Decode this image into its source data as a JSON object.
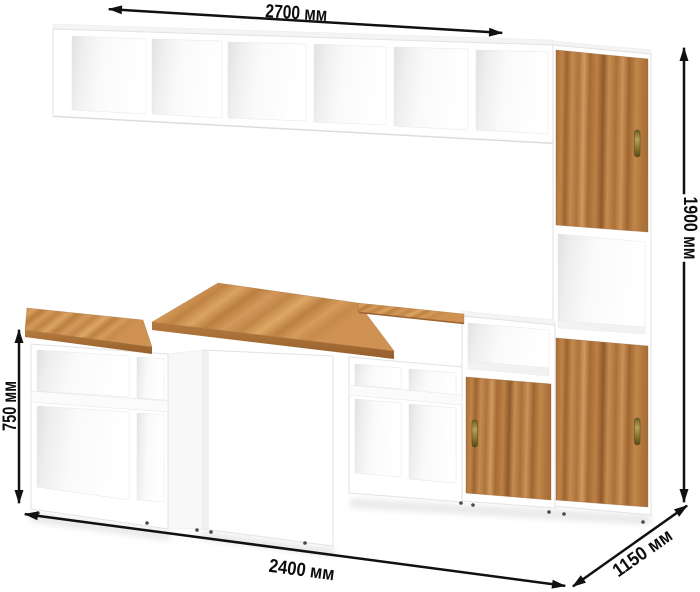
{
  "diagram": {
    "background": "#ffffff",
    "dimension_labels": {
      "top_width": "2700 мм",
      "right_height": "1900 мм",
      "left_height": "750 мм",
      "bottom_width": "2400 мм",
      "depth": "1150 мм"
    },
    "colors": {
      "dimension_line": "#111111",
      "label_text": "#0d0d0d",
      "cabinet_white": "#ffffff",
      "door_wood": "#b5793f",
      "door_wood_light": "#d09a5c",
      "door_wood_dark": "#8f5a2b",
      "desk_wood": "#c88e4d",
      "handle_brass": "#8d7a33"
    },
    "furniture_parts": [
      "wall-shelf-unit",
      "tall-cabinet-right",
      "middle-step-cabinet",
      "desk-top",
      "left-shelf-unit",
      "center-support-panel",
      "under-desk-shelf-unit"
    ]
  }
}
